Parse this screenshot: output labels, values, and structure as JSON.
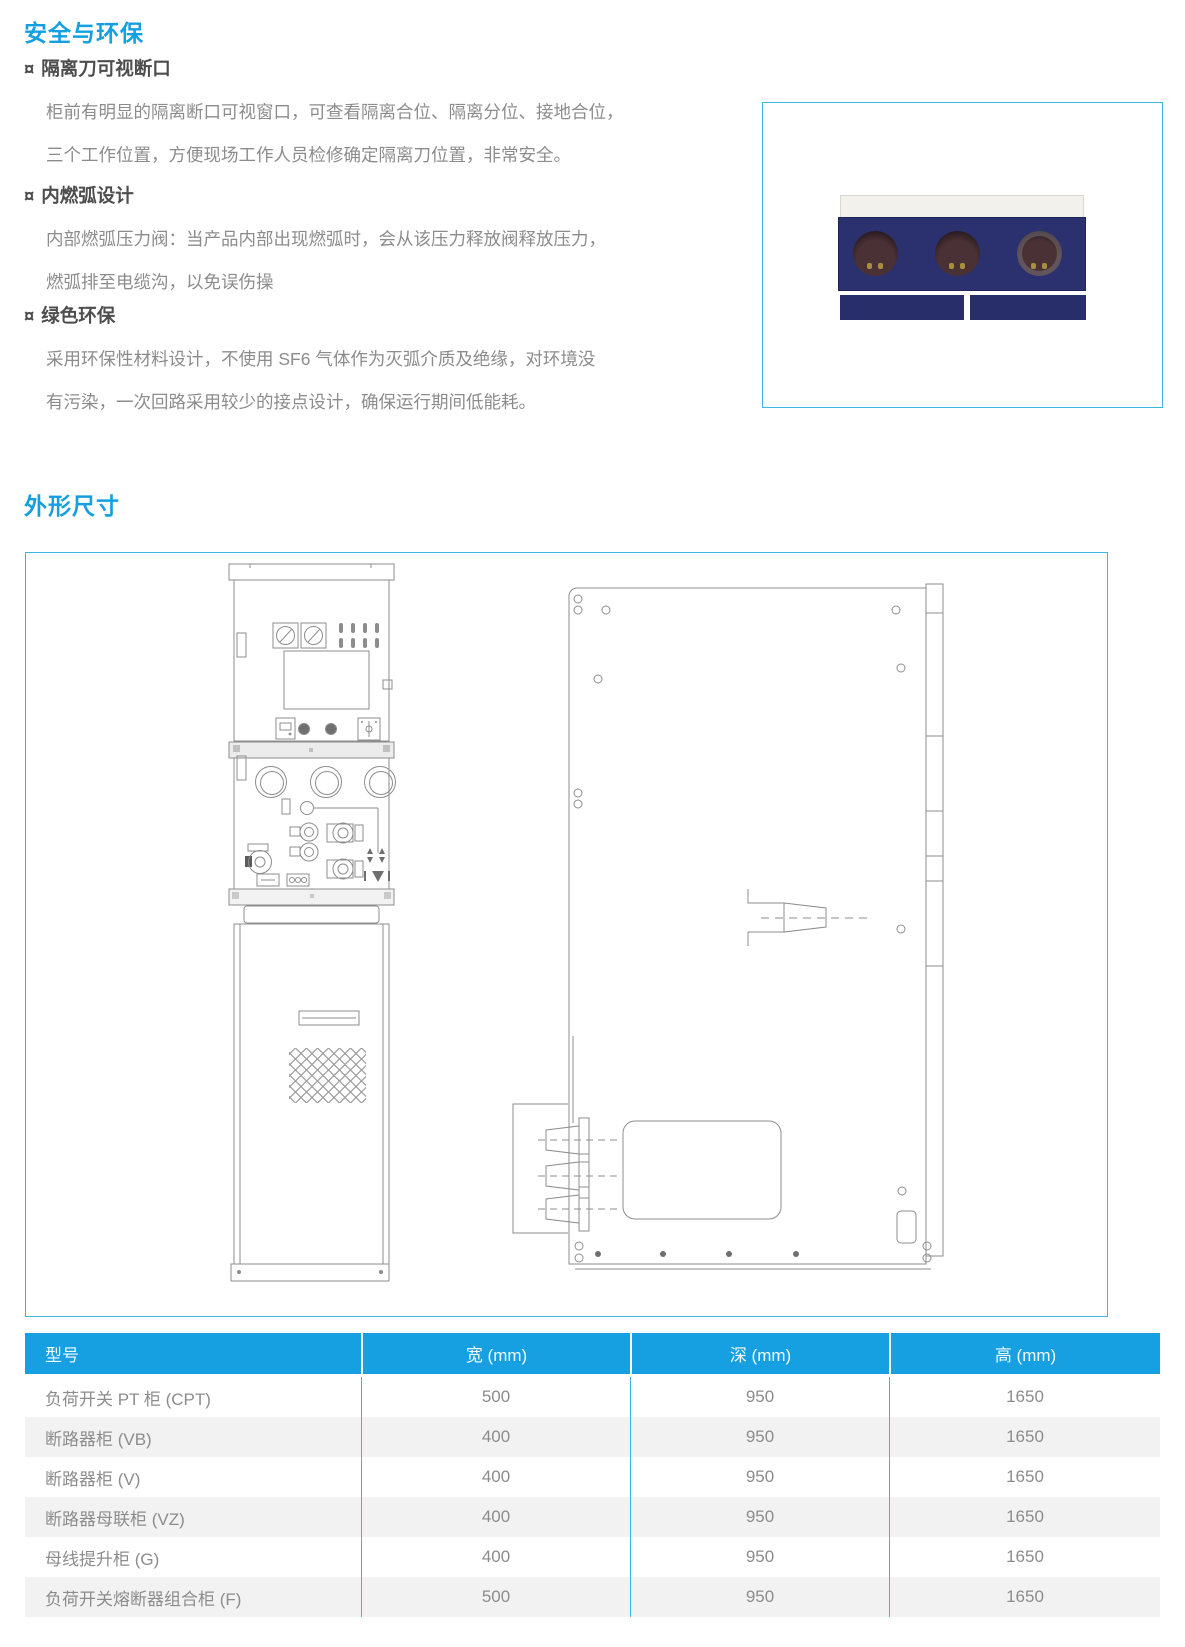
{
  "safety_section": {
    "title": "安全与环保",
    "features": [
      {
        "bullet": "¤",
        "heading": "隔离刀可视断口",
        "line1": "柜前有明显的隔离断口可视窗口，可查看隔离合位、隔离分位、接地合位，",
        "line2": "三个工作位置，方便现场工作人员检修确定隔离刀位置，非常安全。"
      },
      {
        "bullet": "¤",
        "heading": "内燃弧设计",
        "line1": "内部燃弧压力阀：当产品内部出现燃弧时，会从该压力释放阀释放压力，",
        "line2": "燃弧排至电缆沟，以免误伤操"
      },
      {
        "bullet": "¤",
        "heading": "绿色环保",
        "line1": "采用环保性材料设计，不使用 SF6 气体作为灭弧介质及绝缘，对环境没",
        "line2": "有污染，一次回路采用较少的接点设计，确保运行期间低能耗。"
      }
    ]
  },
  "dimensions_section": {
    "title": "外形尺寸"
  },
  "table": {
    "headers": [
      "型号",
      "宽 (mm)",
      "深 (mm)",
      "高 (mm)"
    ],
    "rows": [
      {
        "model": "负荷开关 PT 柜 (CPT)",
        "width": "500",
        "depth": "950",
        "height": "1650"
      },
      {
        "model": "断路器柜 (VB)",
        "width": "400",
        "depth": "950",
        "height": "1650"
      },
      {
        "model": "断路器柜 (V)",
        "width": "400",
        "depth": "950",
        "height": "1650"
      },
      {
        "model": "断路器母联柜 (VZ)",
        "width": "400",
        "depth": "950",
        "height": "1650"
      },
      {
        "model": "母线提升柜 (G)",
        "width": "400",
        "depth": "950",
        "height": "1650"
      },
      {
        "model": "负荷开关熔断器组合柜 (F)",
        "width": "500",
        "depth": "950",
        "height": "1650"
      }
    ]
  },
  "colors": {
    "accent_blue": "#149fe1",
    "table_header_blue": "#16a0e1",
    "box_border_blue": "#3db5e8",
    "panel_navy": "#2a316e",
    "body_text_gray": "#8c8c8c"
  }
}
